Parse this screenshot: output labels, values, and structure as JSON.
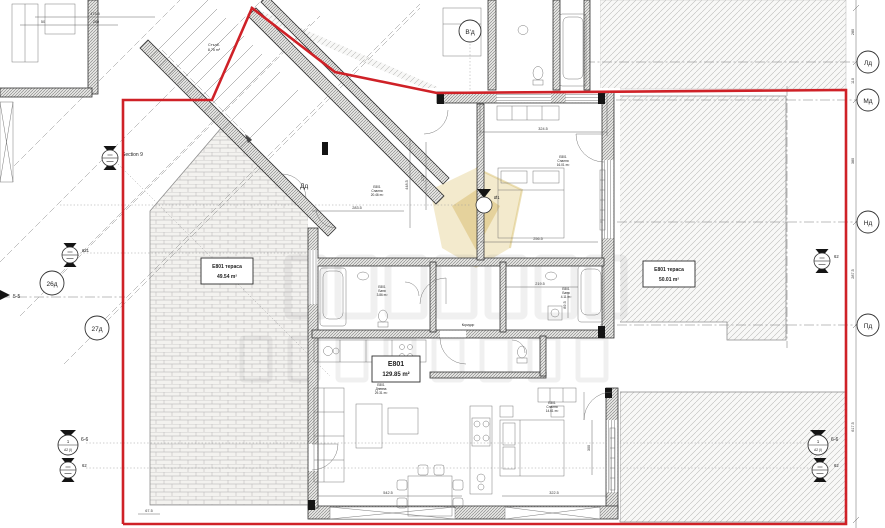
{
  "labels": {
    "section9": "Section 9",
    "terrace_left_name": "E801 тераса",
    "terrace_left_area": "49.54 m²",
    "terrace_right_name": "E801 тераса",
    "terrace_right_area": "50.01 m²",
    "apt_id": "E801",
    "apt_area": "129.85 m²",
    "stairs_name": "Стълб.",
    "stairs_area": "8.75 m²",
    "bedroom_top_id": "E801",
    "bedroom_top_name": "Спалня",
    "bedroom_top_area": "20.46 m²",
    "bedroom_right_id": "E801",
    "bedroom_right_name": "Спалня",
    "bedroom_right_area": "16.01 m²",
    "bedroom_bottom_id": "E801",
    "bedroom_bottom_name": "Спалня",
    "bedroom_bottom_area": "14.61 m²",
    "living_id": "E801",
    "living_name": "Дневна",
    "living_area": "29.31 m²",
    "bath1_id": "E801",
    "bath1_name": "Баня",
    "bath1_area": "3.86 m²",
    "bath2_id": "E801",
    "bath2_name": "Баня",
    "bath2_area": "4.11 m²",
    "corridor_name": "Коридор"
  },
  "axes": {
    "vd": "В'д",
    "ld": "Лд",
    "md": "Мд",
    "nd": "Нд",
    "pd": "Пд",
    "b26": "26д",
    "b27": "27д",
    "dd": "Дд",
    "g1": "Ø1"
  },
  "markers": {
    "elev_621": "621",
    "elev_62": "62",
    "sec_66": "6-6",
    "sec_55": "5-5",
    "sec_num": "1",
    "sec_sheet": "A2 (I)"
  },
  "dims": {
    "d324": "324.5",
    "d256": "256.5",
    "d283": "283.5",
    "d448": "448.5",
    "d172": "172",
    "d219": "219.5",
    "d89": "89.5",
    "d542": "542.5",
    "d322": "322.5",
    "d300": "300",
    "d280": "280",
    "d110": "110",
    "d380": "380",
    "d287": "287.5",
    "d617": "617.5",
    "d67": "67.5",
    "d473": "473.5",
    "d50": "50",
    "d260": "260"
  },
  "colors": {
    "boundary_red": "#cf2127",
    "line": "#3c3c3c",
    "hatch": "#b4b4b4"
  }
}
